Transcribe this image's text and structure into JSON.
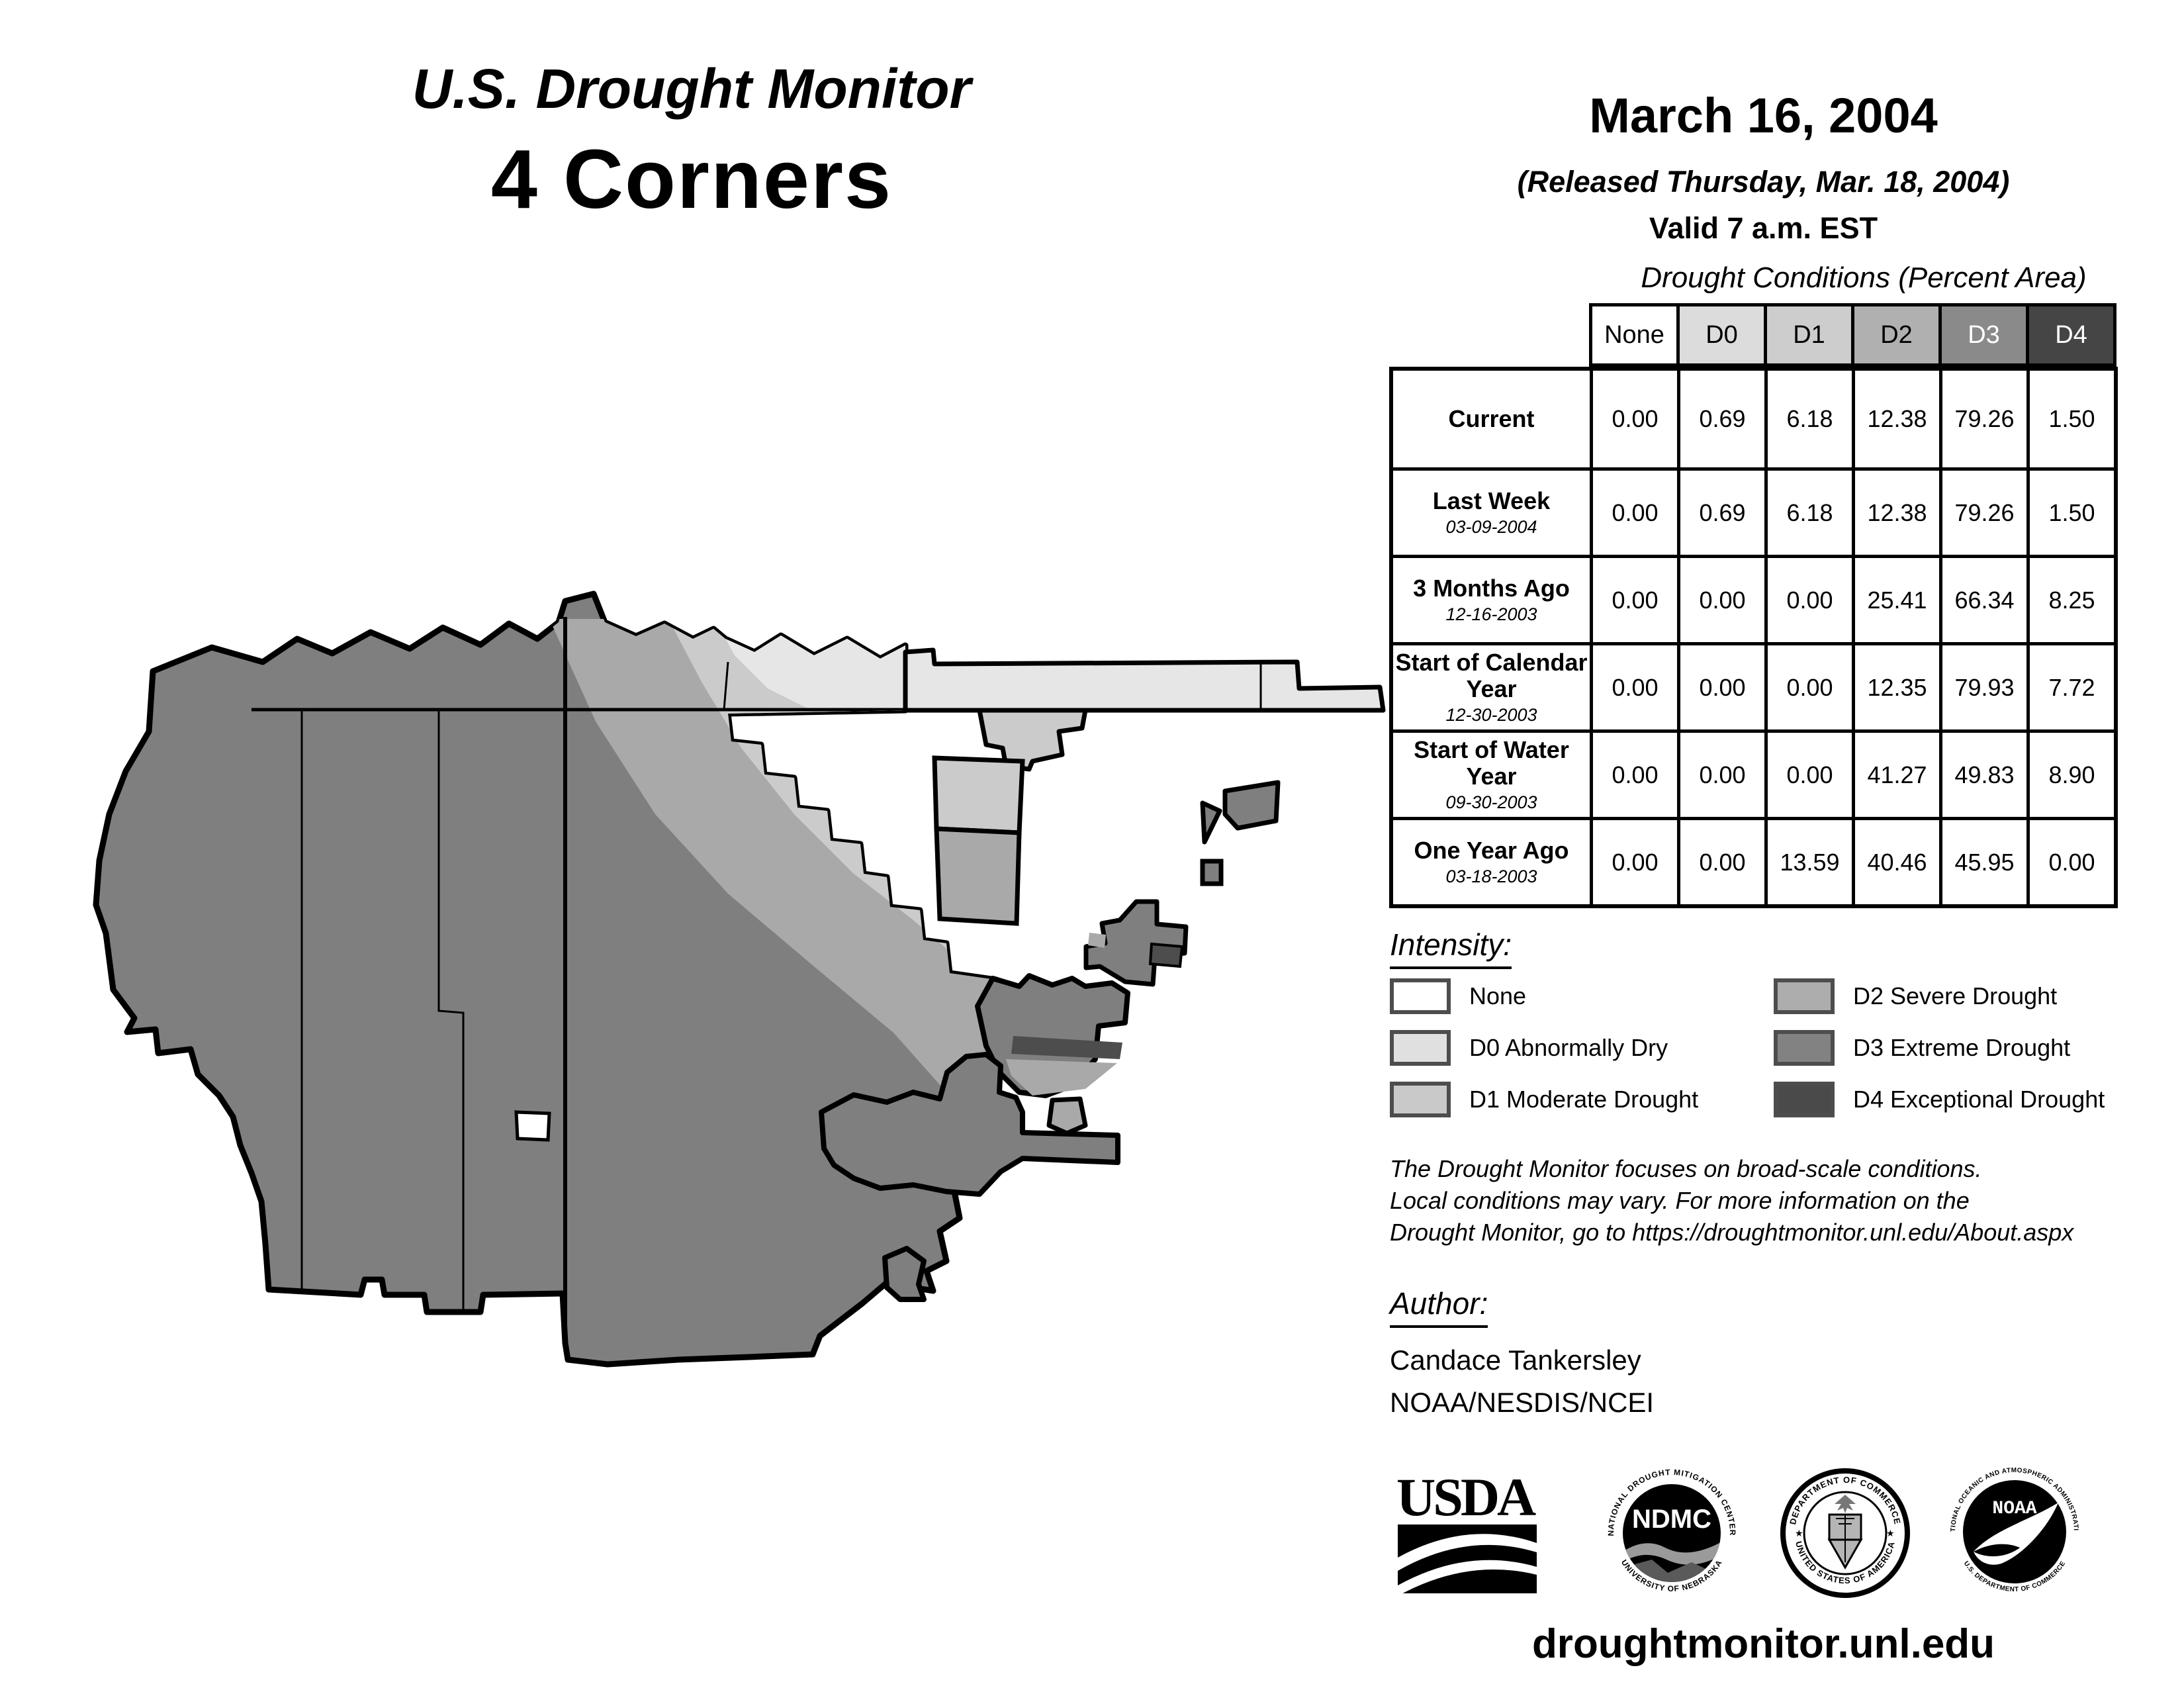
{
  "header": {
    "title": "U.S. Drought Monitor",
    "region": "4 Corners"
  },
  "date_block": {
    "date": "March 16, 2004",
    "released": "(Released Thursday, Mar. 18, 2004)",
    "valid": "Valid 7 a.m. EST"
  },
  "table": {
    "title": "Drought Conditions (Percent Area)",
    "columns": [
      "None",
      "D0",
      "D1",
      "D2",
      "D3",
      "D4"
    ],
    "column_colors": [
      "#ffffff",
      "#dcdcdc",
      "#cdcdcd",
      "#b0b0b0",
      "#8a8a8a",
      "#454545"
    ],
    "column_text_colors": [
      "#000000",
      "#000000",
      "#000000",
      "#000000",
      "#ffffff",
      "#ffffff"
    ],
    "rows": [
      {
        "label": "Current",
        "date": "",
        "values": [
          "0.00",
          "0.69",
          "6.18",
          "12.38",
          "79.26",
          "1.50"
        ]
      },
      {
        "label": "Last Week",
        "date": "03-09-2004",
        "values": [
          "0.00",
          "0.69",
          "6.18",
          "12.38",
          "79.26",
          "1.50"
        ]
      },
      {
        "label": "3 Months Ago",
        "date": "12-16-2003",
        "values": [
          "0.00",
          "0.00",
          "0.00",
          "25.41",
          "66.34",
          "8.25"
        ]
      },
      {
        "label": "Start of Calendar Year",
        "date": "12-30-2003",
        "values": [
          "0.00",
          "0.00",
          "0.00",
          "12.35",
          "79.93",
          "7.72"
        ]
      },
      {
        "label": "Start of Water Year",
        "date": "09-30-2003",
        "values": [
          "0.00",
          "0.00",
          "0.00",
          "41.27",
          "49.83",
          "8.90"
        ]
      },
      {
        "label": "One Year Ago",
        "date": "03-18-2003",
        "values": [
          "0.00",
          "0.00",
          "13.59",
          "40.46",
          "45.95",
          "0.00"
        ]
      }
    ]
  },
  "legend": {
    "heading": "Intensity:",
    "items": [
      {
        "label": "None",
        "color": "#ffffff"
      },
      {
        "label": "D0 Abnormally Dry",
        "color": "#e0e0e0"
      },
      {
        "label": "D1 Moderate Drought",
        "color": "#c9c9c9"
      },
      {
        "label": "D2 Severe Drought",
        "color": "#adadad"
      },
      {
        "label": "D3 Extreme Drought",
        "color": "#828282"
      },
      {
        "label": "D4 Exceptional Drought",
        "color": "#4a4a4a"
      }
    ]
  },
  "disclaimer": {
    "line1": "The Drought Monitor focuses on broad-scale conditions.",
    "line2": "Local conditions may vary. For more information on the",
    "line3": "Drought Monitor, go to https://droughtmonitor.unl.edu/About.aspx"
  },
  "author": {
    "heading": "Author:",
    "name": "Candace Tankersley",
    "org": "NOAA/NESDIS/NCEI"
  },
  "logos": {
    "usda": {
      "text": "USDA"
    },
    "ndmc": {
      "text": "NDMC",
      "arc_top": "NATIONAL DROUGHT MITIGATION CENTER",
      "arc_bottom": "UNIVERSITY OF NEBRASKA"
    },
    "commerce": {
      "arc_top": "DEPARTMENT OF COMMERCE",
      "arc_bottom": "UNITED STATES OF AMERICA"
    },
    "noaa": {
      "text": "NOAA",
      "arc_top": "NATIONAL OCEANIC AND ATMOSPHERIC ADMINISTRATION",
      "arc_bottom": "U.S. DEPARTMENT OF COMMERCE"
    }
  },
  "footer": {
    "url": "droughtmonitor.unl.edu"
  },
  "map": {
    "region_label": "4 Corners drought intensity map",
    "categories": {
      "none": "#ffffff",
      "d0": "#e6e6e6",
      "d1": "#cbcbcb",
      "d2": "#a9a9a9",
      "d3": "#7f7f7f",
      "d4": "#4d4d4d"
    }
  }
}
